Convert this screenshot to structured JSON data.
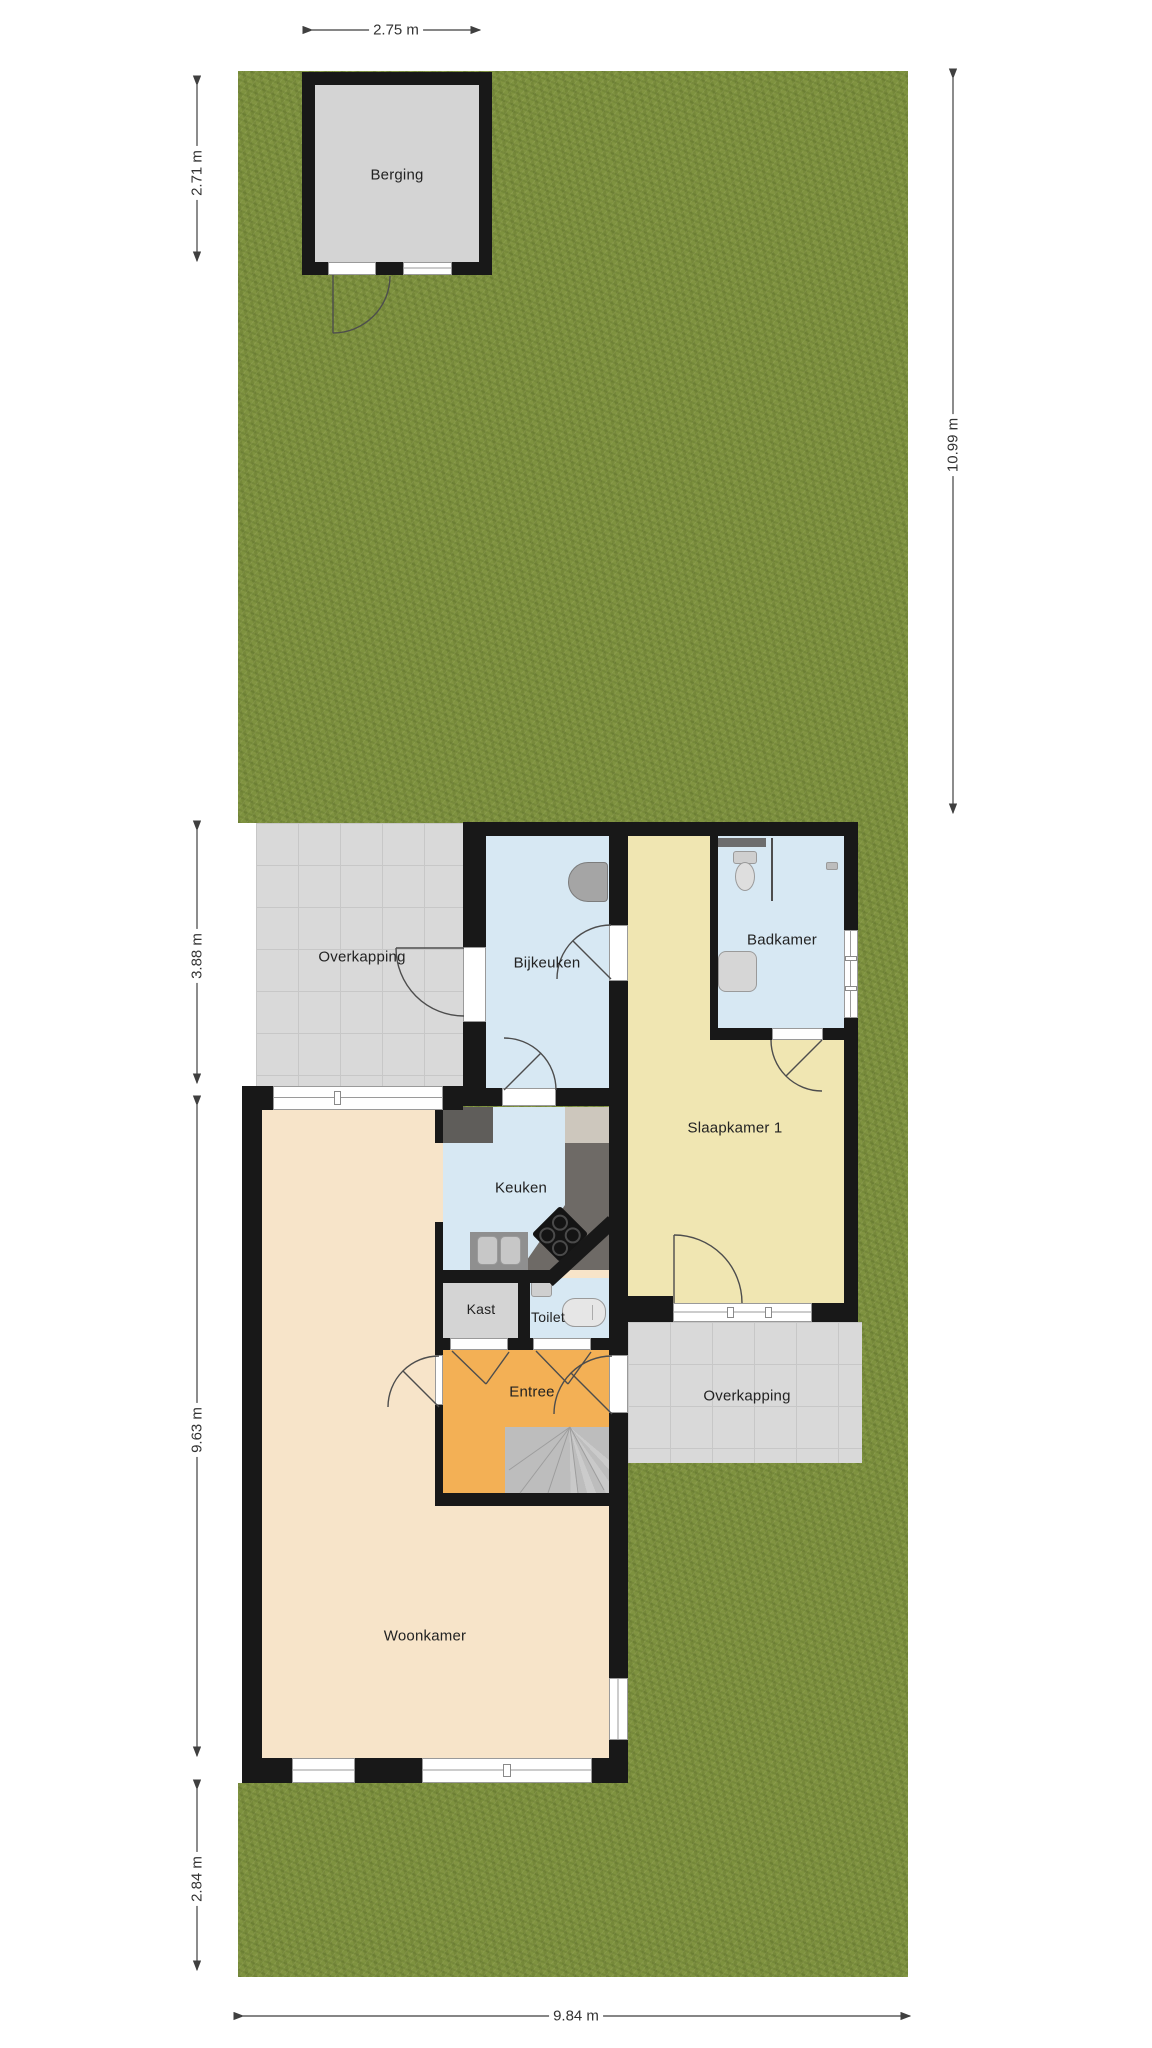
{
  "rooms": {
    "berging": "Berging",
    "overkapping_left": "Overkapping",
    "bijkeuken": "Bijkeuken",
    "badkamer": "Badkamer",
    "slaapkamer1": "Slaapkamer 1",
    "keuken": "Keuken",
    "kast": "Kast",
    "toilet": "Toilet",
    "entree": "Entree",
    "overkapping_right": "Overkapping",
    "woonkamer": "Woonkamer"
  },
  "dimensions": {
    "shed_width": "2.75 m",
    "shed_depth": "2.71 m",
    "garden_depth": "10.99 m",
    "overkapping_depth": "3.88 m",
    "house_depth": "9.63 m",
    "garden_front_depth": "2.84 m",
    "plot_width": "9.84 m"
  },
  "colors": {
    "grass": "#7e923f",
    "tile": "#d9d9d9",
    "wall": "#181818",
    "room_blue": "#d7e8f3",
    "room_yellow": "#f0e6b2",
    "room_peach": "#f7e4c9",
    "room_orange": "#f3b055",
    "room_gray": "#d4d4d4",
    "counter_dark": "#5f5d5a",
    "counter_mid": "#6e6a66",
    "fixture": "#cfcfcf"
  }
}
